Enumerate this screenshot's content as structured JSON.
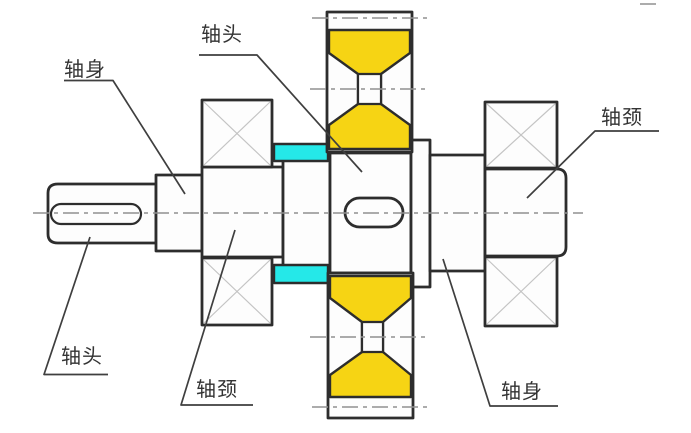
{
  "diagram": {
    "labels": {
      "top_left": "轴身",
      "top_center": "轴头",
      "right": "轴颈",
      "bottom_left": "轴头",
      "bottom_center": "轴颈",
      "bottom_right": "轴身"
    },
    "colors": {
      "wheel_fill": "#F6D414",
      "spacer_fill": "#25E8E8",
      "outline": "#2D2D2D",
      "centerline": "#909090",
      "hatch_cross": "#C4C4C4",
      "label_text": "#333333",
      "background": "#FFFFFF"
    }
  }
}
